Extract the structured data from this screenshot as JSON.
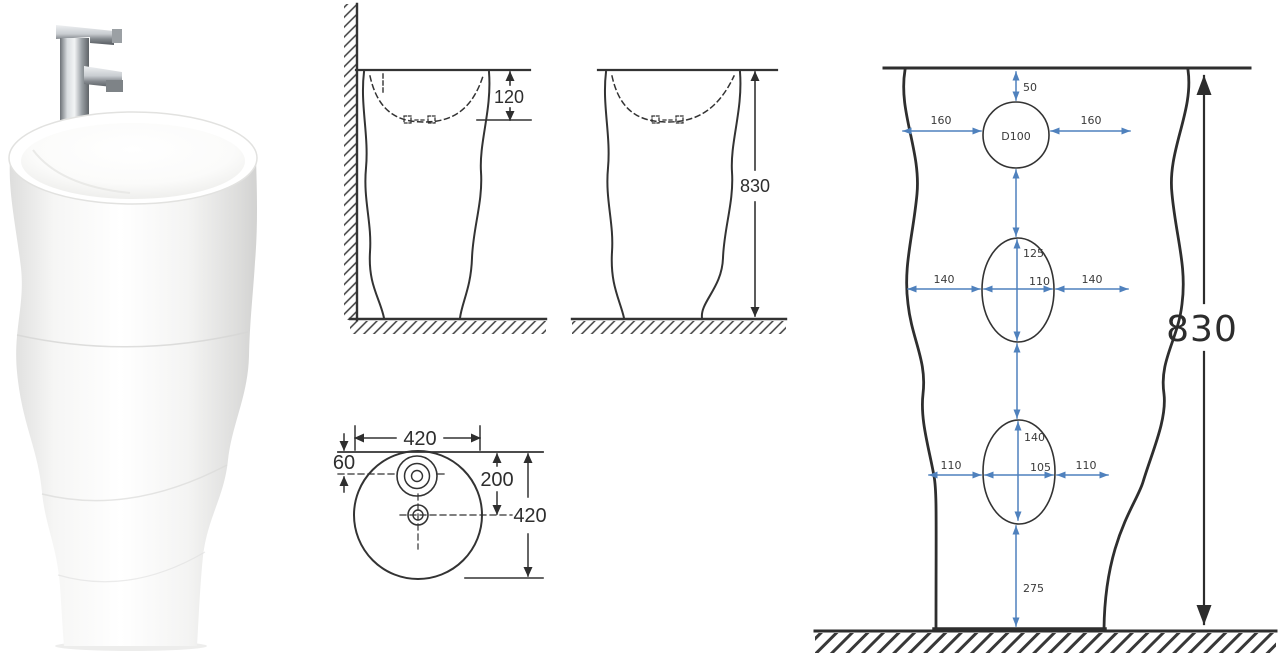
{
  "colors": {
    "background": "#ffffff",
    "drawing_line": "#333333",
    "front_view_line": "#2e2e2e",
    "dimension_text": "#2e2e2e",
    "blue_dimension": "#4f81bd"
  },
  "product": {
    "type": "freestanding-pedestal-basin-with-faucet"
  },
  "side_view_wall": {
    "basin_depth": "120"
  },
  "side_view_free": {
    "overall_height": "830"
  },
  "top_view": {
    "top_width": "420",
    "faucet_center_offset": "60",
    "drain_center_offset": "200",
    "overall_depth": "420"
  },
  "front_view": {
    "rim_to_faucet_hole": "50",
    "faucet_hole_diameter": "D100",
    "faucet_hole_left_gap": "160",
    "faucet_hole_right_gap": "160",
    "mid_hole_height": "125",
    "mid_hole_width": "110",
    "mid_hole_left_gap": "140",
    "mid_hole_right_gap": "140",
    "low_hole_height": "140",
    "low_hole_width": "105",
    "low_hole_left_gap": "110",
    "low_hole_right_gap": "110",
    "hole_to_floor": "275",
    "overall_height": "830"
  }
}
